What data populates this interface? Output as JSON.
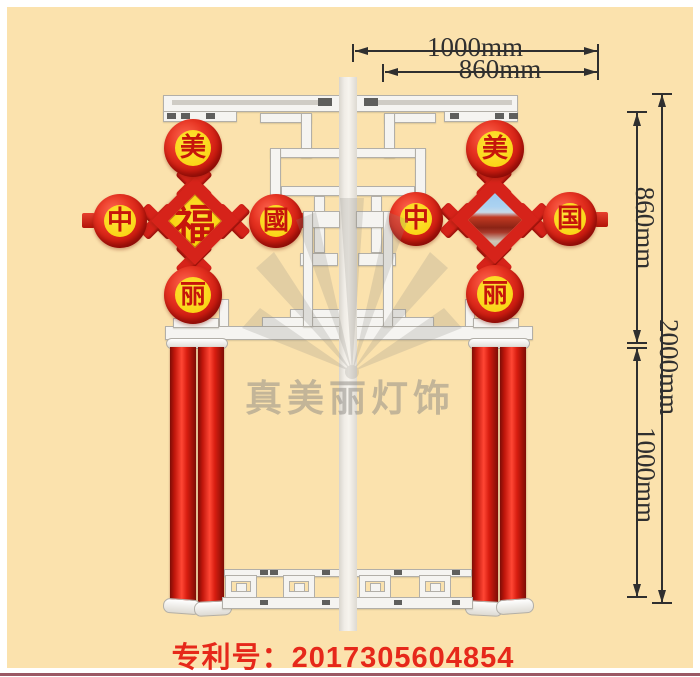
{
  "product": {
    "description": "Chinese knot street lamp decoration diagram",
    "watermark_brand": "真美丽灯饰",
    "patent_text": "专利号：2017305604854"
  },
  "dims": {
    "top": [
      {
        "label": "1000mm"
      },
      {
        "label": "860mm"
      }
    ],
    "right": [
      {
        "label": "860mm"
      },
      {
        "label": "2000mm"
      },
      {
        "label": "1000mm"
      }
    ]
  },
  "knot_left": {
    "top_character": "美",
    "left_character": "中",
    "right_character": "國",
    "bottom_character": "丽",
    "center_character": "福"
  },
  "knot_right": {
    "top_character": "美",
    "left_character": "中",
    "right_character": "国",
    "bottom_character": "丽",
    "center_content": "tiananmen-photo"
  },
  "colors": {
    "background": "#fbe2ad",
    "knot_red": "#d6231a",
    "knot_yellow": "#ffd912",
    "structure_white": "#f5f4f1",
    "patent_red": "#e6281a",
    "frame_line": "#9b5864"
  }
}
